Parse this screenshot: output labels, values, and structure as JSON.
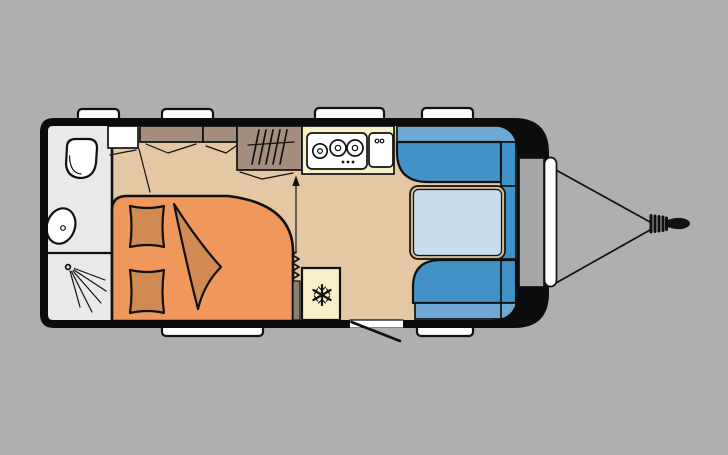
{
  "diagram": {
    "type": "caravan-floor-plan",
    "orientation": "top view, rear at left, drawbar hitch at right",
    "windows": {
      "top_count": 4,
      "bottom_count": 2
    },
    "areas": {
      "washroom": {
        "fixtures": [
          "toilet",
          "washbasin",
          "shower",
          "corner-cabinet"
        ]
      },
      "bedroom": {
        "furniture": [
          "double-bed",
          "pillow",
          "pillow",
          "blanket",
          "overhead-locker",
          "overhead-locker",
          "wardrobe",
          "pleated-screen",
          "direction-arrow"
        ]
      },
      "kitchen": {
        "appliances": [
          "three-burner-hob",
          "sink-with-taps",
          "refrigerator"
        ]
      },
      "dinette": {
        "furniture": [
          "rear-facing-bench",
          "forward-facing-bench",
          "side-bench",
          "table"
        ]
      },
      "front": {
        "features": [
          "gas-locker",
          "front-service-hatch",
          "drawbar",
          "hitch-coupling"
        ]
      },
      "entrance": {
        "features": [
          "door-opening",
          "door-swing-line"
        ]
      }
    },
    "hob_burners": 3,
    "wardrobe_hanger_strokes": 5
  },
  "colors": {
    "background": "#afafaf",
    "outline": "#111111",
    "body_black": "#0c0c0c",
    "floor_tan": "#e3c8a3",
    "washroom_gray": "#e9e9e9",
    "cabinet_taupe": "#a48d7c",
    "counter_cream": "#f9f0ca",
    "appliance_white": "#ffffff",
    "bed_orange": "#f0985c",
    "bedding_orange": "#d08a52",
    "seat_blue": "#4292c7",
    "seat_light_blue": "#6fa9d3",
    "table_top_blue": "#c9dbef",
    "table_edge_tan": "#d4ba98",
    "window_white": "#ffffff",
    "drawbar_gray": "#a6a6a6",
    "partition_gray": "#8b8076"
  }
}
